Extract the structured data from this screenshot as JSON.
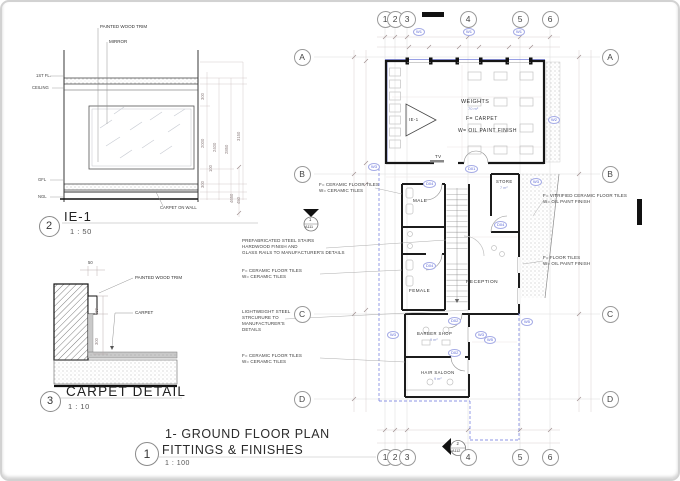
{
  "colors": {
    "accent_blue": "#5b67d8",
    "wall": "#161616",
    "paper": "#ffffff"
  },
  "details": {
    "ie1": {
      "bubble": "2",
      "title": "IE-1",
      "scale": "1 : 50",
      "label_painted_wood_trim": "PAINTED WOOD TRIM",
      "label_mirror": "MIRROR",
      "label_carpet_on_wall": "CARPET ON WALL",
      "floor_labels": {
        "first_fl": "1ST FL.",
        "ceiling": "CEILING",
        "gfl": "GFL",
        "ngl": "NGL"
      },
      "dims": {
        "d300_top": "300",
        "d2000": "2000",
        "d100": "100",
        "d300_bottom": "300",
        "d2400": "2400",
        "d2850": "2850",
        "d3150": "3150",
        "d450": "450"
      }
    },
    "carpet": {
      "bubble": "3",
      "title": "CARPET  DETAIL",
      "scale": "1 : 10",
      "label_painted_wood_trim": "PAINTED WOOD TRIM",
      "label_carpet": "CARPET",
      "dims": {
        "d50": "50",
        "d100": "100",
        "d300": "300"
      }
    }
  },
  "plan": {
    "title": {
      "bubble": "1",
      "line1": "1- GROUND FLOOR PLAN",
      "line2": "FITTINGS & FINISHES",
      "scale": "1 : 100"
    },
    "grid": {
      "cols": [
        "1",
        "2",
        "3",
        "4",
        "5",
        "6"
      ],
      "rows": [
        "A",
        "B",
        "C",
        "D"
      ]
    },
    "rooms": {
      "weights": {
        "name": "WEIGHTS",
        "area": "70 m²",
        "finish_floor": "F= CARPET",
        "finish_wall": "W= OIL PAINT FINISH"
      },
      "male": {
        "name": "MALE"
      },
      "female": {
        "name": "FEMALE"
      },
      "store": {
        "name": "STORE",
        "area": "7 m²"
      },
      "reception": {
        "name": "RECEPTION"
      },
      "barber": {
        "name": "BARBER SHOP",
        "area": "9 m²"
      },
      "hair": {
        "name": "HAIR SALOON",
        "area": "9 m²"
      },
      "tv": "TV"
    },
    "notes": {
      "left1a": "F=  CERAMIC FLOOR TILES",
      "left1b": "W= CERAMIC TILES",
      "stairs1": "PREFABRICATED STEEL STAIRS",
      "stairs2": "HARDWOOD FINISH AND",
      "stairs3": "GLASS RAILS TO MANUFACTURER'S DETAILS",
      "left2a": "F=  CERAMIC FLOOR TILES",
      "left2b": "W= CERAMIC TILES",
      "steel1": "LIGHTWEIGHT STEEL",
      "steel2": "STRCURURE TO",
      "steel3": "MANUFACTURER'S",
      "steel4": "DETAILS",
      "left3a": "F=  CERAMIC FLOOR TILES",
      "left3b": "W= CERAMIC TILES",
      "right1a": "F= VITRIFIED CERAMIC FLOOR TILES",
      "right1b": "W= OIL PAINT FINISH",
      "right2a": "F=  FLOOR TILES",
      "right2b": "W= OIL PAINT FINISH"
    },
    "tags": {
      "w1": "W1",
      "w2": "W2",
      "w3": "W3",
      "w5": "W5",
      "d01": "D01",
      "d02": "D02",
      "d04": "D04",
      "ie1": "IE-1"
    },
    "markers": {
      "section1_no": "1",
      "section1_sheet": "A111",
      "section2_no": "2",
      "section2_sheet": "A112"
    },
    "dims": {
      "left_height": "4650"
    }
  }
}
